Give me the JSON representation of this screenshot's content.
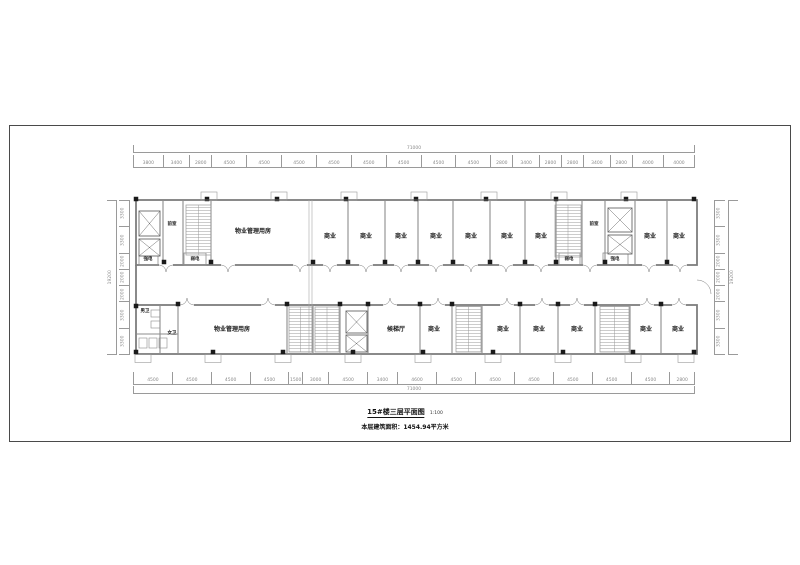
{
  "drawing": {
    "title": "15#楼三层平面图",
    "scale": "1:100",
    "area_note": "本层建筑面积：1454.94平方米"
  },
  "rooms": {
    "shop": "商业",
    "property_mgmt": "物业管理用房",
    "vestibule": "前室",
    "elevator_hall": "候梯厅",
    "strong_electric": "强电",
    "weak_electric": "弱电",
    "mens_wc": "男卫",
    "womens_wc": "女卫"
  },
  "dimensions": {
    "overall_width_top": [
      "71000"
    ],
    "overall_width_bottom": [
      "71000"
    ],
    "overall_height_left": [
      "19200"
    ],
    "overall_height_right": [
      "19200"
    ],
    "top_segments": [
      "3800",
      "3400",
      "2800",
      "4500",
      "4500",
      "4500",
      "4500",
      "4500",
      "4500",
      "4500",
      "4500",
      "2800",
      "3400",
      "2800",
      "2800",
      "3400",
      "2800",
      "4000",
      "4000"
    ],
    "bottom_segments": [
      "4500",
      "4500",
      "4500",
      "4500",
      "1500",
      "3000",
      "4500",
      "3400",
      "4600",
      "4500",
      "4500",
      "4500",
      "4500",
      "4500",
      "4500",
      "2800"
    ],
    "left_segments": [
      "3300",
      "3300",
      "2000",
      "2000",
      "2000",
      "3300",
      "3300"
    ],
    "right_segments": [
      "3300",
      "3300",
      "2000",
      "2000",
      "2000",
      "3300",
      "3300"
    ]
  }
}
